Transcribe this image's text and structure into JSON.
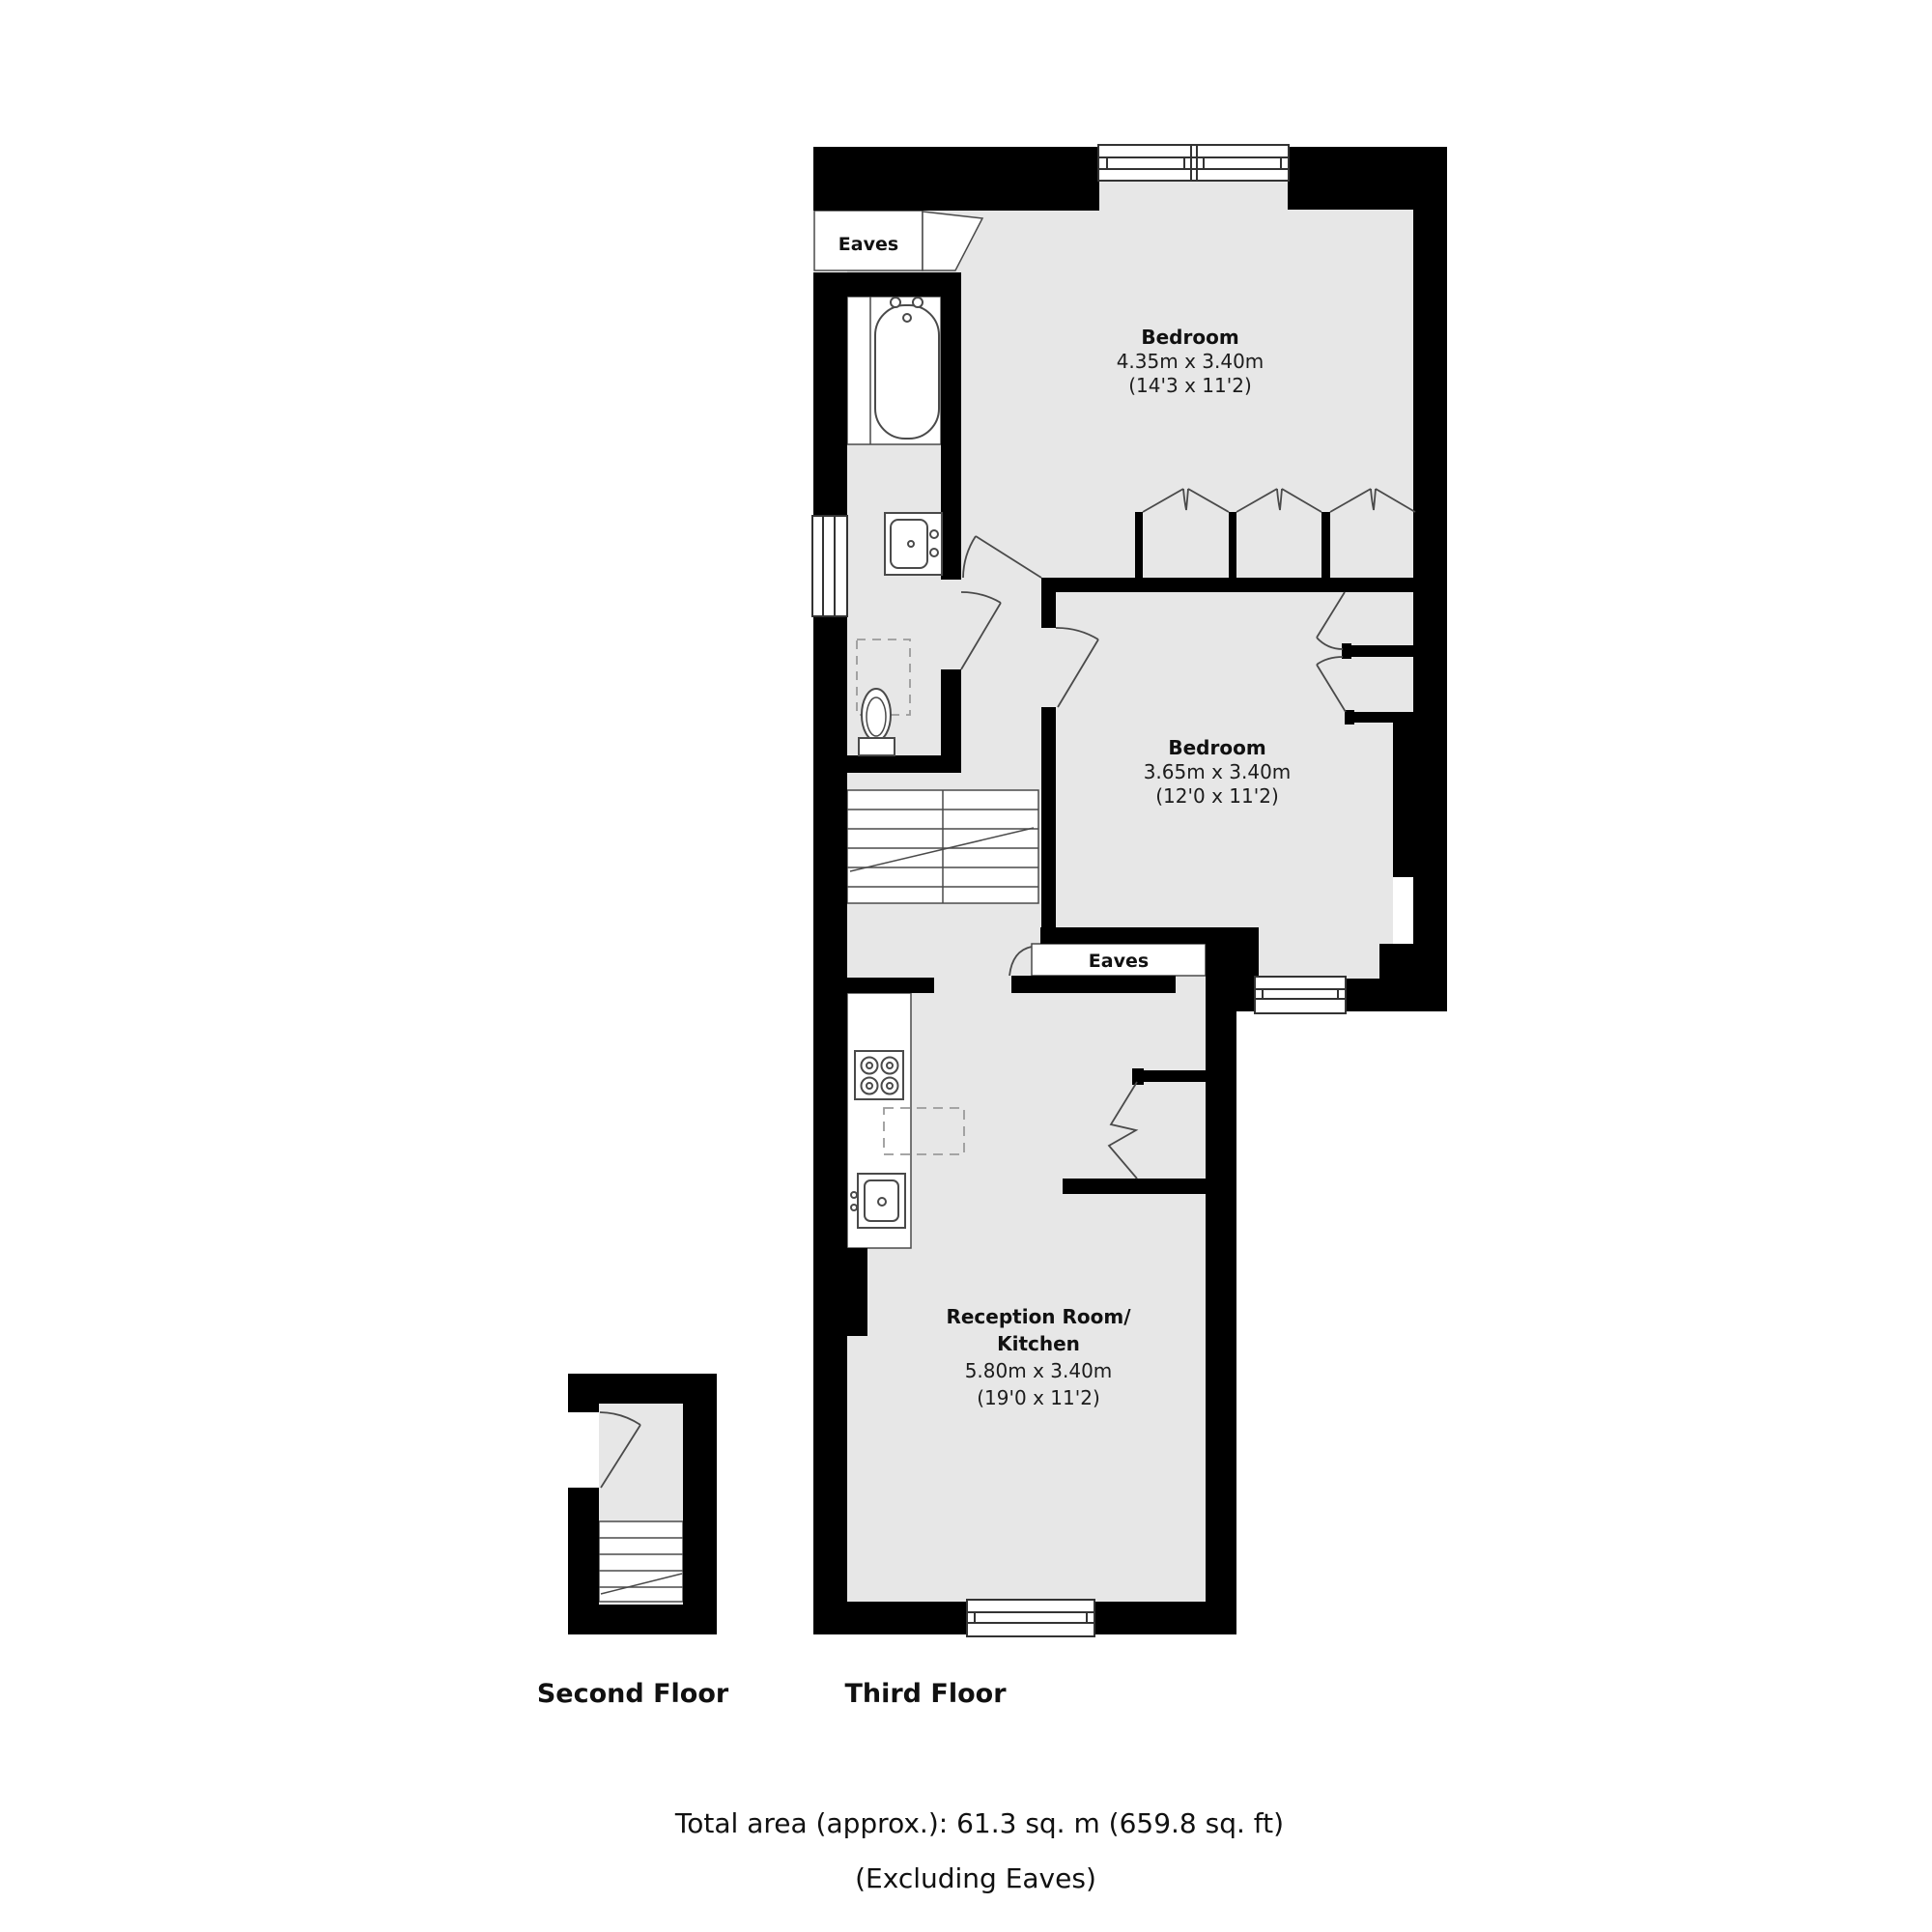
{
  "floors": {
    "second": "Second Floor",
    "third": "Third Floor"
  },
  "rooms": {
    "bedroom_large": {
      "name": "Bedroom",
      "size_metric": "4.35m x 3.40m",
      "size_imperial": "(14'3 x 11'2)"
    },
    "bedroom_small": {
      "name": "Bedroom",
      "size_metric": "3.65m x 3.40m",
      "size_imperial": "(12'0 x 11'2)"
    },
    "reception": {
      "name_line1": "Reception Room/",
      "name_line2": "Kitchen",
      "size_metric": "5.80m x 3.40m",
      "size_imperial": "(19'0 x 11'2)"
    }
  },
  "eaves": {
    "upper": "Eaves",
    "lower": "Eaves"
  },
  "footer": {
    "total_area": "Total area (approx.): 61.3 sq. m (659.8 sq. ft)",
    "note": "(Excluding Eaves)"
  },
  "icons": [
    "bathtub-icon",
    "toilet-icon",
    "bathroom-sink-icon",
    "hob-icon",
    "kitchen-sink-icon",
    "staircase",
    "window",
    "door-arc",
    "closet-doors",
    "folding-door"
  ],
  "colors": {
    "wall": "#000000",
    "floor": "#e7e7e7",
    "line": "#4a4a4a",
    "background": "#ffffff"
  }
}
